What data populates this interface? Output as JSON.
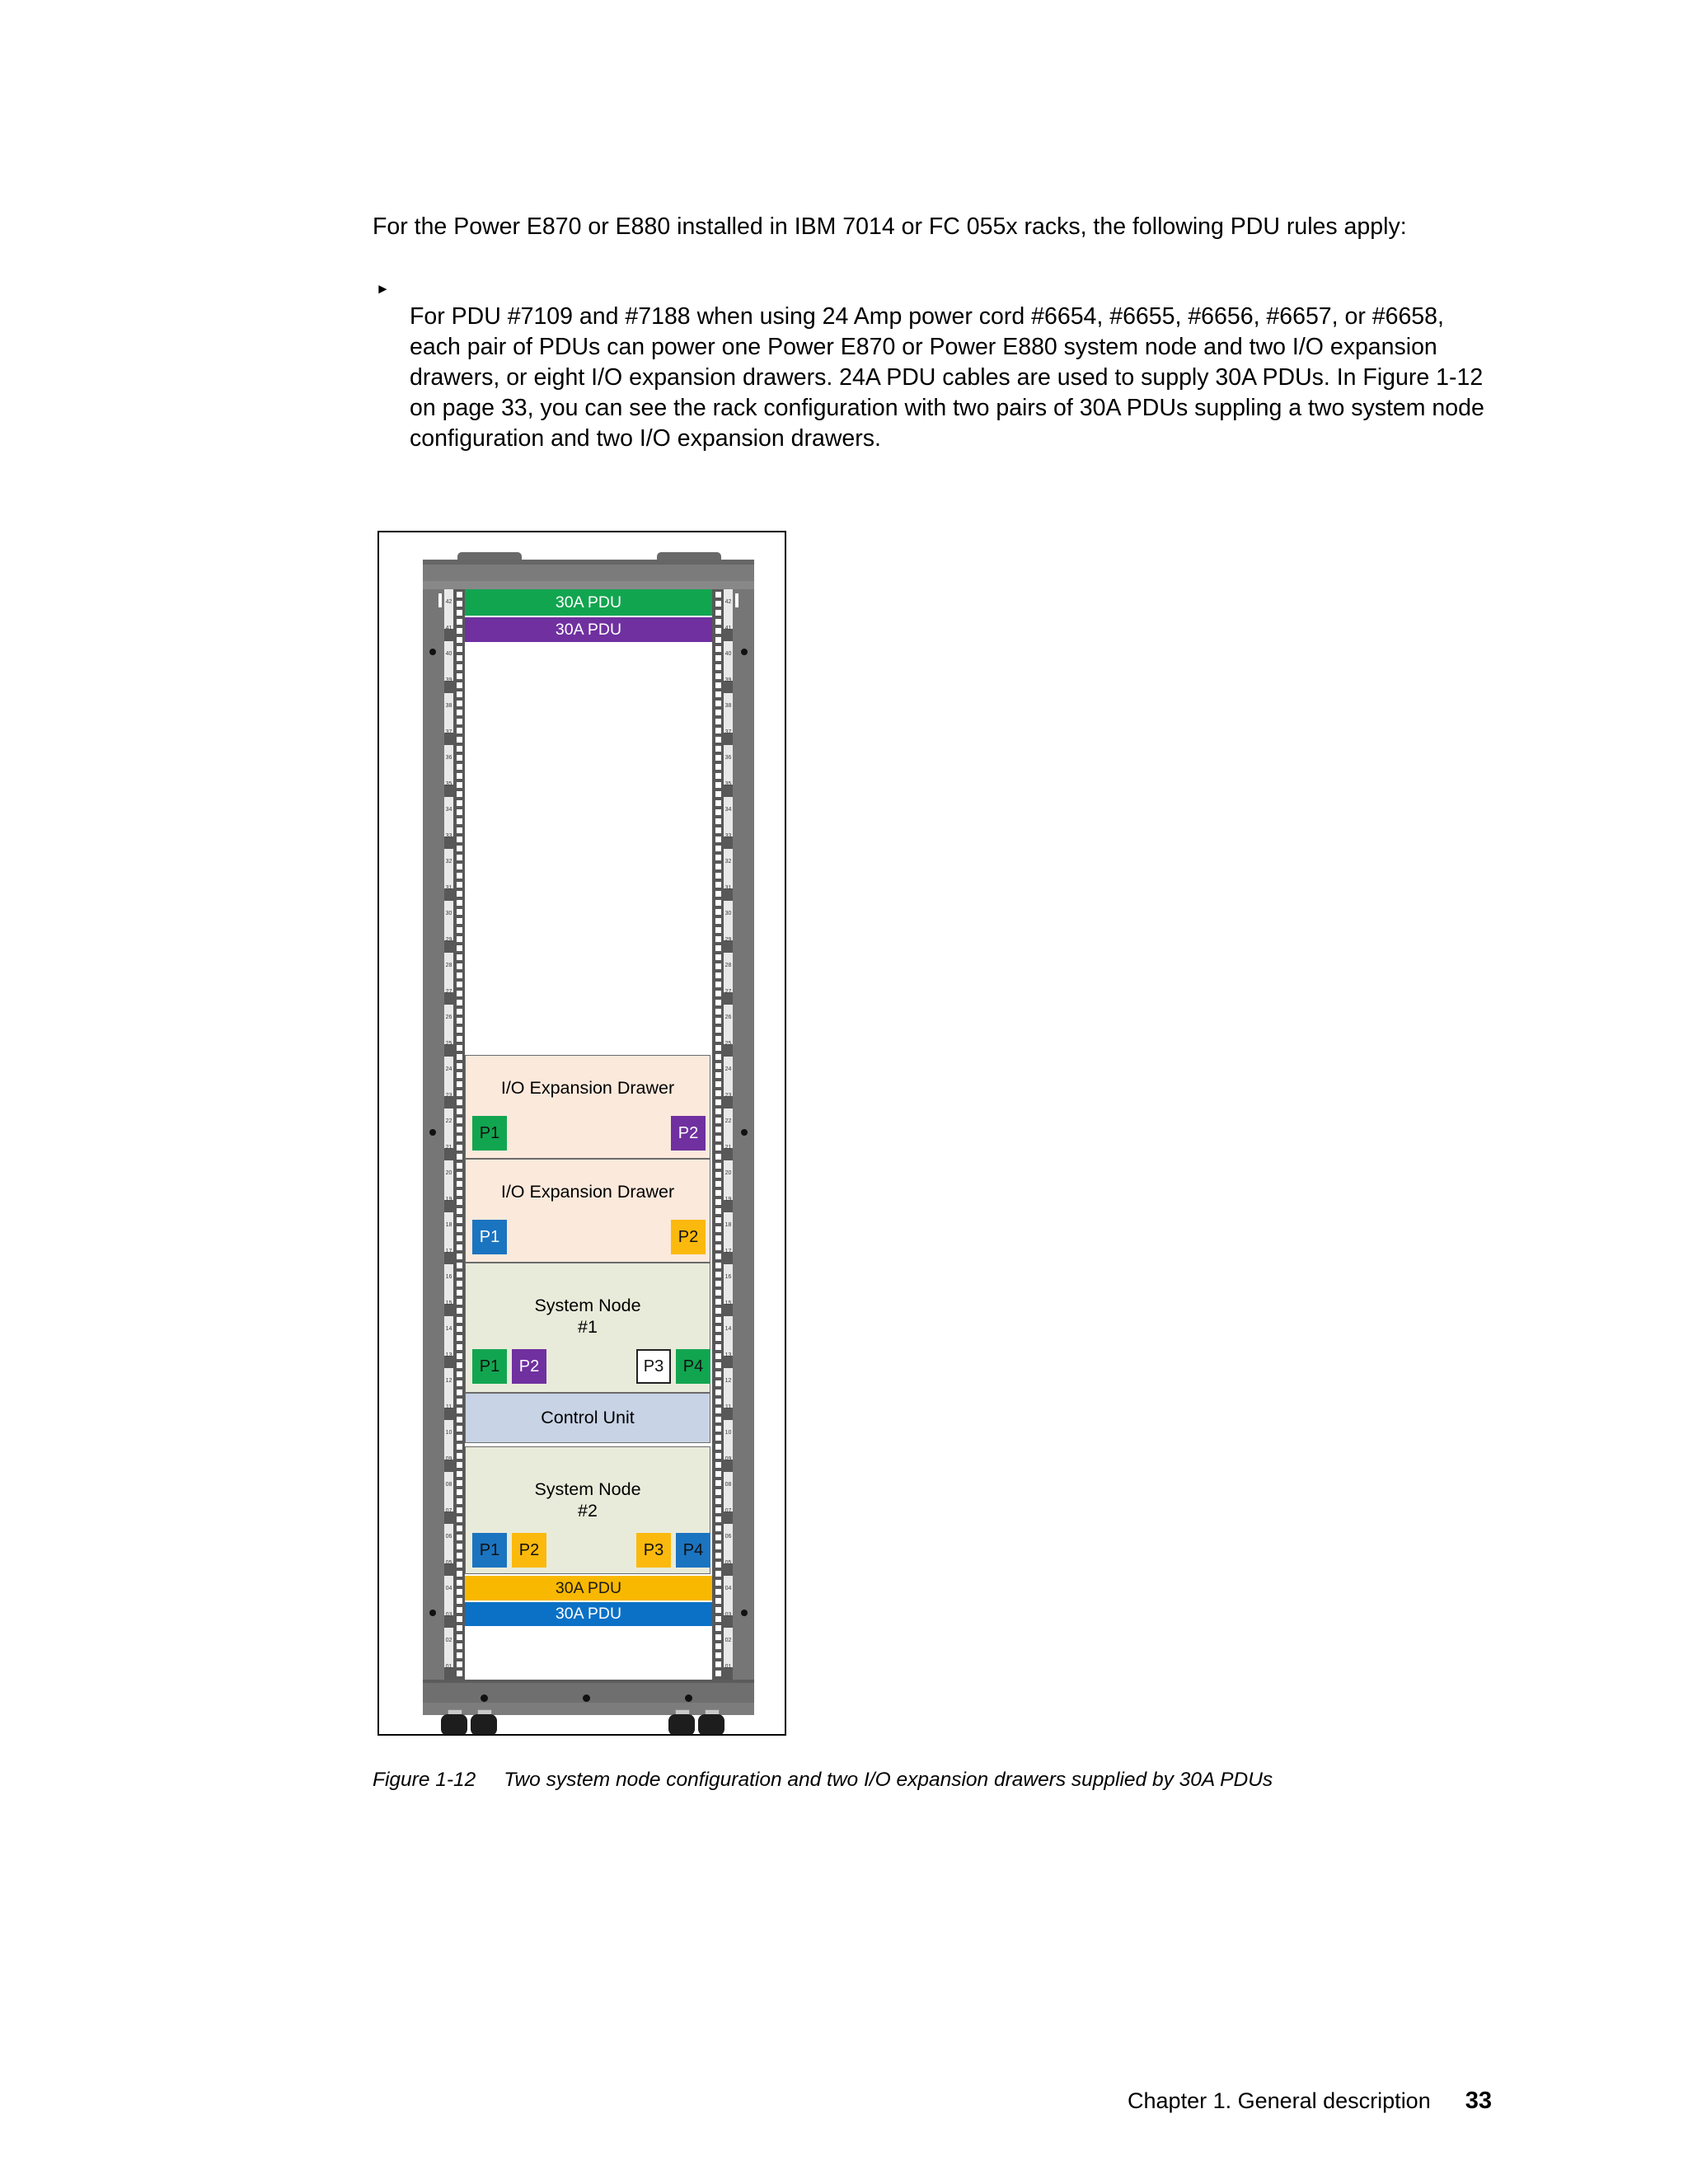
{
  "content": {
    "intro": "For the Power E870 or E880 installed in IBM 7014 or FC 055x racks, the following PDU rules apply:",
    "bullet": {
      "marker": "►",
      "text": "For PDU #7109 and #7188 when using 24 Amp power cord #6654, #6655, #6656, #6657, or #6658, each pair of PDUs can power one Power E870 or Power E880 system node and two I/O expansion drawers, or eight I/O expansion drawers. 24A PDU cables are used to supply 30A PDUs. In Figure 1-12 on page 33, you can see the rack configuration with two pairs of 30A PDUs suppling a two system node configuration and two I/O expansion drawers."
    }
  },
  "figure": {
    "caption_label": "Figure 1-12",
    "caption_text": "Two system node configuration and two I/O expansion drawers supplied by 30A PDUs",
    "rack": {
      "top_pdus": [
        {
          "label": "30A PDU",
          "bg": "#12A550",
          "fg": "#FFFFFF"
        },
        {
          "label": "30A PDU",
          "bg": "#7030A0",
          "fg": "#FFFFFF"
        }
      ],
      "io_drawers": [
        {
          "title": "I/O Expansion Drawer",
          "bg": "#FBE9DC",
          "ports": [
            {
              "label": "P1",
              "bg": "#12A550",
              "fg": "#111111"
            },
            {
              "label": "P2",
              "bg": "#7030A0",
              "fg": "#FFFFFF"
            }
          ]
        },
        {
          "title": "I/O Expansion Drawer",
          "bg": "#FBE9DC",
          "ports": [
            {
              "label": "P1",
              "bg": "#1B74C0",
              "fg": "#FFFFFF"
            },
            {
              "label": "P2",
              "bg": "#FBB90D",
              "fg": "#111111"
            }
          ]
        }
      ],
      "system_nodes": [
        {
          "title": "System Node",
          "subtitle": "#1",
          "bg": "#E9EBDA",
          "ports": [
            {
              "label": "P1",
              "bg": "#12A550",
              "fg": "#111111"
            },
            {
              "label": "P2",
              "bg": "#7030A0",
              "fg": "#FFFFFF"
            },
            {
              "label": "P3",
              "bg": "#FFFFFF",
              "fg": "#111111",
              "border": "#222222"
            },
            {
              "label": "P4",
              "bg": "#12A550",
              "fg": "#111111"
            }
          ]
        },
        {
          "title": "System Node",
          "subtitle": "#2",
          "bg": "#E9EBDA",
          "ports": [
            {
              "label": "P1",
              "bg": "#1B74C0",
              "fg": "#111111"
            },
            {
              "label": "P2",
              "bg": "#FBB90D",
              "fg": "#111111"
            },
            {
              "label": "P3",
              "bg": "#FBB90D",
              "fg": "#111111"
            },
            {
              "label": "P4",
              "bg": "#1B74C0",
              "fg": "#111111"
            }
          ]
        }
      ],
      "control_unit": {
        "title": "Control Unit",
        "bg": "#C8D3E5"
      },
      "bottom_pdus": [
        {
          "label": "30A PDU",
          "bg": "#F9B800",
          "fg": "#1A1A1A"
        },
        {
          "label": "30A PDU",
          "bg": "#0B71C6",
          "fg": "#FFFFFF"
        }
      ],
      "rail_units": [
        "42",
        "41",
        "40",
        "39",
        "38",
        "37",
        "36",
        "35",
        "34",
        "33",
        "32",
        "31",
        "30",
        "29",
        "28",
        "27",
        "26",
        "25",
        "24",
        "23",
        "22",
        "21",
        "20",
        "19",
        "18",
        "17",
        "16",
        "15",
        "14",
        "13",
        "12",
        "11",
        "10",
        "09",
        "08",
        "07",
        "06",
        "05",
        "04",
        "03",
        "02",
        "01"
      ]
    }
  },
  "page": {
    "footer_chapter": "Chapter 1. General description",
    "footer_page_number": "33"
  }
}
